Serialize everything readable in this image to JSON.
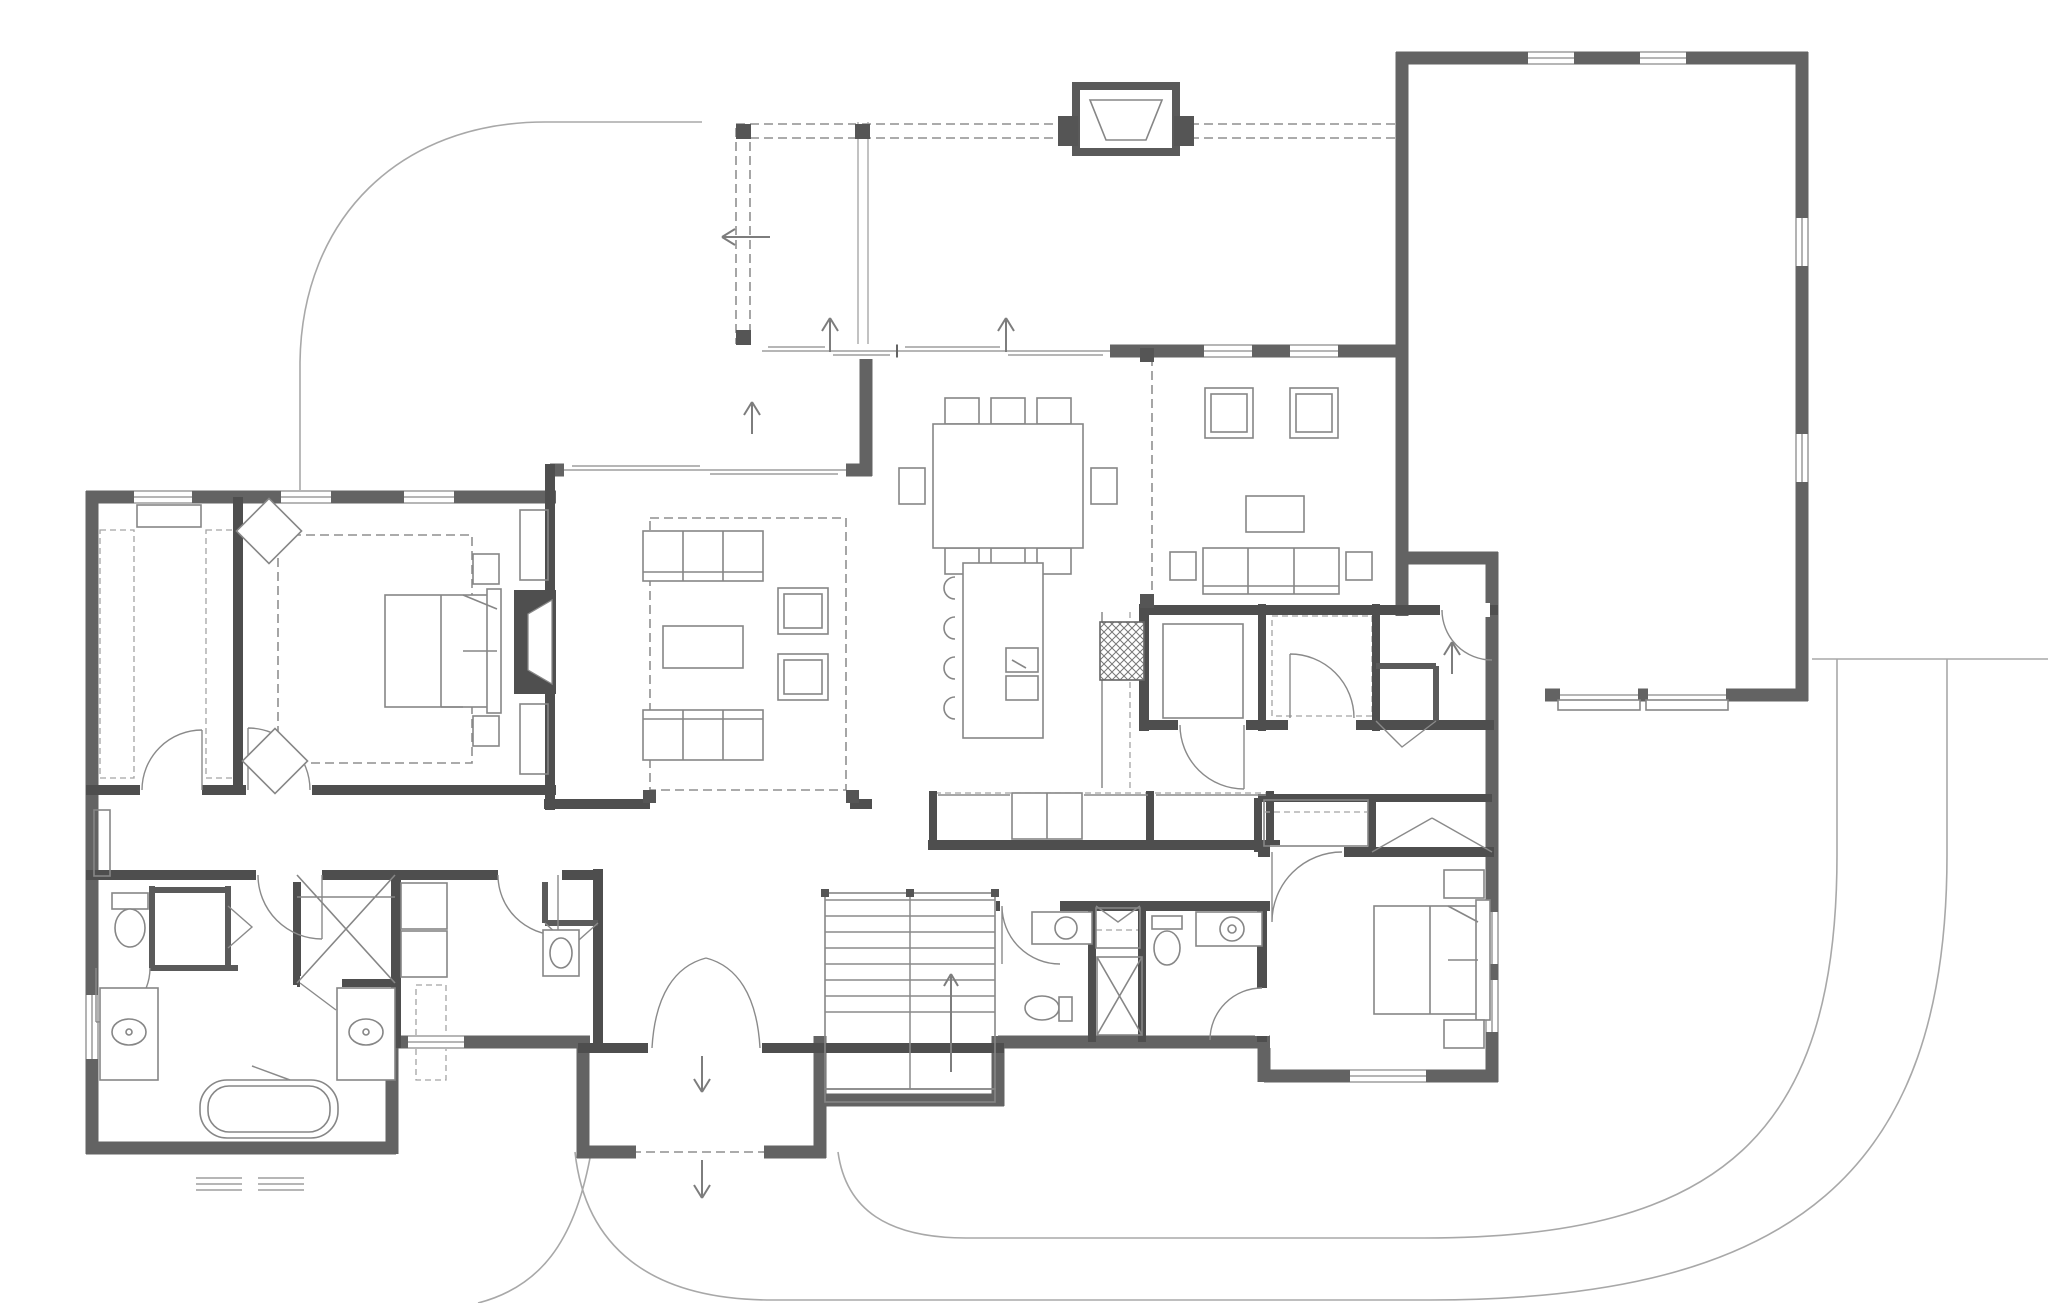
{
  "colors": {
    "wall_exterior": "#636363",
    "wall_interior": "#4e4e4e",
    "line": "#8a8a8a",
    "text": "#1b1b1b",
    "background": "#ffffff"
  },
  "rooms": [
    {
      "id": "uncovered-patio",
      "title": [
        "UNCOVERED",
        "PATIO"
      ],
      "dims": [
        "18'-9\" x 19'-7\""
      ],
      "x": 618,
      "y": 287
    },
    {
      "id": "covered-porch",
      "title": [
        "COVERED",
        "PORCH"
      ],
      "dims": [
        "30'-9\" x 12'-10\""
      ],
      "x": 1130,
      "y": 232
    },
    {
      "id": "garage",
      "title": [
        "3-CAR",
        "GARAGE"
      ],
      "dims": [
        "23'-0\" x 35'-8\"+"
      ],
      "x": 1597,
      "y": 372
    },
    {
      "id": "family-dining",
      "title": [
        "FAMILY",
        "DINING"
      ],
      "dims": [
        "16'-0\" x 12'-0\""
      ],
      "x": 1008,
      "y": 452
    },
    {
      "id": "den",
      "title": [
        "DEN"
      ],
      "dims": [
        "14'-0\" x 14'-0\""
      ],
      "x": 1272,
      "y": 480
    },
    {
      "id": "great-room",
      "title": [
        "GREAT",
        "ROOM"
      ],
      "dims": [
        "18'-0\" x 18'-2\"",
        "12'-1\" CLG.",
        "OPT. BEAMS"
      ],
      "x": 612,
      "y": 650
    },
    {
      "id": "kitchen",
      "title": [
        "KITCHEN"
      ],
      "dims": [
        "16'-0\" x 15'-7\""
      ],
      "x": 1070,
      "y": 764
    },
    {
      "id": "pantry",
      "title": [
        "PANTRY"
      ],
      "dims": [
        "7'-1\" x 6'-11\""
      ],
      "x": 1205,
      "y": 662
    },
    {
      "id": "wic",
      "title": [
        "W.I.C."
      ],
      "dims": [
        "6'-7\" x 6'-5\""
      ],
      "x": 1327,
      "y": 650
    },
    {
      "id": "mud-hall",
      "title": [
        "MUD HALL"
      ],
      "dims": [
        "12'-10\" x 4'-2\""
      ],
      "x": 1338,
      "y": 764
    },
    {
      "id": "primary-suite",
      "title": [
        "PRIMARY",
        "SUITE"
      ],
      "dims": [
        "15'-0\" x 17'-1\"",
        "10'-1\" REC. CLG."
      ],
      "x": 333,
      "y": 646
    },
    {
      "id": "walk-in-closet",
      "title": [
        "WALK-IN",
        "CLOSET"
      ],
      "dims": [
        "8'-1\" x 17'-1\""
      ],
      "x": 168,
      "y": 644
    },
    {
      "id": "primary-bath",
      "title": [
        "PRIMARY",
        "BATH"
      ],
      "dims": [
        "15'-9\"+ x 16'-11\""
      ],
      "x": 243,
      "y": 1006
    },
    {
      "id": "laundry",
      "title": [
        "LAUNDRY"
      ],
      "dims": [
        "10'-1\" x 9'-1\""
      ],
      "x": 505,
      "y": 953
    },
    {
      "id": "foyer",
      "title": [
        "FOYER"
      ],
      "dims": [
        "14'-0\" x 13'-4\"",
        "10'-7\" CLG."
      ],
      "x": 700,
      "y": 922
    },
    {
      "id": "covered-entry",
      "title": [
        "COVERED",
        "ENTRY"
      ],
      "dims": [
        "12'-1\" x 5'-0\""
      ],
      "x": 700,
      "y": 1090
    },
    {
      "id": "pwdr",
      "title": [
        "PWDR."
      ],
      "dims": [
        "6'-10\" x 5'-9\""
      ],
      "x": 1032,
      "y": 980
    },
    {
      "id": "bath-2",
      "title": [
        "BATH 2"
      ],
      "dims": [
        "6'-10\" x 7'-1\"+"
      ],
      "x": 1196,
      "y": 978
    },
    {
      "id": "guest-suite",
      "title": [
        "GUEST",
        "SUITE"
      ],
      "dims": [
        "12'-9\" x 12'-10\""
      ],
      "x": 1332,
      "y": 1014
    }
  ],
  "annotations": [
    {
      "id": "gas-fp-36",
      "lines": [
        "36\" V.F. GAS FP."
      ],
      "x": 1127,
      "y": 163
    },
    {
      "id": "grill-area",
      "lines": [
        "GRILL AREA"
      ],
      "x": 1381,
      "y": 243,
      "r": -90
    },
    {
      "id": "sgd-porch",
      "lines": [
        "12'-0\" x 8'-0\" S.G.D."
      ],
      "x": 1006,
      "y": 373
    },
    {
      "id": "sgd-patio",
      "lines": [
        "12'-0\" x 8'-0\" S.G.D."
      ],
      "x": 830,
      "y": 373
    },
    {
      "id": "sgd-great-room",
      "lines": [
        "16'-0\" x 8'-0\" S.G.D."
      ],
      "x": 700,
      "y": 493
    },
    {
      "id": "dn-walkway",
      "lines": [
        "DN"
      ],
      "x": 776,
      "y": 228
    },
    {
      "id": "dn-porch-sgd",
      "lines": [
        "DN"
      ],
      "x": 993,
      "y": 340,
      "r": -90
    },
    {
      "id": "dn-patio-sgd",
      "lines": [
        "DN"
      ],
      "x": 817,
      "y": 340,
      "r": -90
    },
    {
      "id": "dn-great-sgd",
      "lines": [
        "DN"
      ],
      "x": 739,
      "y": 446,
      "r": -90
    },
    {
      "id": "built-in-top",
      "lines": [
        "BUILT-IN"
      ],
      "x": 527,
      "y": 546,
      "r": -90
    },
    {
      "id": "built-in-bottom",
      "lines": [
        "BUILT-IN"
      ],
      "x": 527,
      "y": 746,
      "r": -90
    },
    {
      "id": "gas-fp-45",
      "lines": [
        "45\" D.V. GAS FP."
      ],
      "x": 563,
      "y": 643,
      "r": -90
    },
    {
      "id": "co-right",
      "lines": [
        "14' x 8' C.O."
      ],
      "x": 876,
      "y": 645,
      "r": -90
    },
    {
      "id": "co-bottom",
      "lines": [
        "14' x 8' C.O."
      ],
      "x": 700,
      "y": 816
    },
    {
      "id": "island",
      "lines": [
        "9'-6\" x 4'-0\" ISLAND"
      ],
      "x": 986,
      "y": 650,
      "r": -90
    },
    {
      "id": "range-hood",
      "lines": [
        "36\" RANGE",
        "W/HOOD"
      ],
      "x": 1078,
      "y": 646,
      "r": -90
    },
    {
      "id": "shelves",
      "lines": [
        "(5) SHELVES"
      ],
      "x": 1205,
      "y": 619
    },
    {
      "id": "utility-mud",
      "lines": [
        "UTILITY"
      ],
      "x": 1407,
      "y": 694
    },
    {
      "id": "dn-garage",
      "lines": [
        "DN"
      ],
      "x": 1441,
      "y": 690,
      "r": -90
    },
    {
      "id": "tv",
      "lines": [
        "TV."
      ],
      "x": 1387,
      "y": 480
    },
    {
      "id": "bourbon",
      "lines": [
        "BOURBON"
      ],
      "x": 972,
      "y": 814
    },
    {
      "id": "ref-48",
      "lines": [
        "48\" REF."
      ],
      "x": 1047,
      "y": 814
    },
    {
      "id": "coffee-bar",
      "lines": [
        "COFFEE BAR &",
        "SMALL APPLIANCES"
      ],
      "x": 1209,
      "y": 820
    },
    {
      "id": "photo-art-wall",
      "lines": [
        "PHOTO/ART WALL"
      ],
      "x": 1083,
      "y": 858
    },
    {
      "id": "bench-cubbies",
      "lines": [
        "BENCH &",
        "CUBBIES"
      ],
      "x": 1318,
      "y": 824
    },
    {
      "id": "guest-clst",
      "lines": [
        "GUEST CLST."
      ],
      "x": 1436,
      "y": 829
    },
    {
      "id": "shoes",
      "lines": [
        "SHOES"
      ],
      "x": 168,
      "y": 516
    },
    {
      "id": "bench-hall",
      "lines": [
        "BENCH"
      ],
      "x": 110,
      "y": 838,
      "r": -90
    },
    {
      "id": "linen",
      "lines": [
        "LINEN"
      ],
      "x": 190,
      "y": 928,
      "r": -90
    },
    {
      "id": "bench-shower",
      "lines": [
        "BENCH"
      ],
      "x": 346,
      "y": 889
    },
    {
      "id": "tiled-shower",
      "lines": [
        "5'-3\" x 6'-1\"",
        "TILED",
        "SHOWER"
      ],
      "x": 346,
      "y": 940
    },
    {
      "id": "dry",
      "lines": [
        "DRY"
      ],
      "x": 424,
      "y": 906,
      "r": -90
    },
    {
      "id": "wash",
      "lines": [
        "WASH"
      ],
      "x": 424,
      "y": 955,
      "r": -90
    },
    {
      "id": "clg-typical",
      "lines": [
        "9'-1\" CLG.,",
        "TYPICAL"
      ],
      "x": 494,
      "y": 842
    },
    {
      "id": "clothes-hanging",
      "lines": [
        "CLOTHES",
        "HANGING"
      ],
      "x": 431,
      "y": 1012,
      "r": -90
    },
    {
      "id": "vanity-left",
      "lines": [
        "5'-0\" VANITY"
      ],
      "x": 140,
      "y": 1037,
      "r": -90
    },
    {
      "id": "vanity-right",
      "lines": [
        "5'-0\" VANITY"
      ],
      "x": 354,
      "y": 1037,
      "r": -90
    },
    {
      "id": "ledge-bath",
      "lines": [
        "LEDGE"
      ],
      "x": 230,
      "y": 1062
    },
    {
      "id": "freestanding-tub",
      "lines": [
        "72\"",
        "FREESTANDING",
        "TUB"
      ],
      "x": 246,
      "y": 1106
    },
    {
      "id": "dn-16r",
      "lines": [
        "DN",
        "16R"
      ],
      "x": 846,
      "y": 905,
      "r": -90
    },
    {
      "id": "ledge-stairs",
      "lines": [
        "LEDGE"
      ],
      "x": 908,
      "y": 1097
    },
    {
      "id": "coats",
      "lines": [
        "COATS"
      ],
      "x": 1119,
      "y": 926
    },
    {
      "id": "utility-laundry",
      "lines": [
        "UTILITY"
      ],
      "x": 568,
      "y": 899,
      "r": -90
    },
    {
      "id": "dn-foyer",
      "lines": [
        "DN"
      ],
      "x": 688,
      "y": 1040,
      "r": -90
    },
    {
      "id": "dn-entry",
      "lines": [
        "DN"
      ],
      "x": 688,
      "y": 1168,
      "r": -90
    }
  ]
}
